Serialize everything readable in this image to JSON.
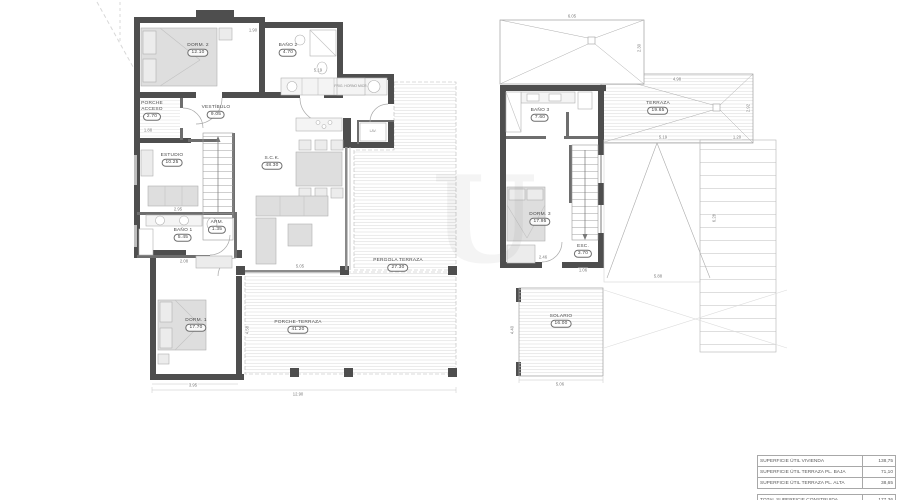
{
  "ground_floor": {
    "rooms": {
      "porche_acceso": {
        "name": "PORCHE ACCESO",
        "area": "2.70"
      },
      "dorm2": {
        "name": "DORM. 2",
        "area": "12.10"
      },
      "bano2": {
        "name": "BAÑO 2",
        "area": "4.70"
      },
      "vestibulo": {
        "name": "VESTÍBULO",
        "area": "9.05"
      },
      "estudio": {
        "name": "ESTUDIO",
        "area": "10.25"
      },
      "sck": {
        "name": "S.C.K.",
        "area": "48.30"
      },
      "bano1": {
        "name": "BAÑO 1",
        "area": "5.45"
      },
      "arm": {
        "name": "ARM.",
        "area": "1.35"
      },
      "dorm1": {
        "name": "DORM. 1",
        "area": "17.70"
      },
      "porche_terraza": {
        "name": "PORCHE-TERRAZA",
        "area": "41.20"
      },
      "pergola_terraza": {
        "name": "PERGOLA TERRAZA",
        "area": "27.30"
      }
    },
    "fixtures": {
      "kitchen_appliances": "FRIG. HORNO MICR.",
      "laundry": "LAV."
    },
    "dims": [
      "1.90",
      "5.19",
      "2.95",
      "2.08",
      "3.95",
      "12.90",
      "5.05",
      "1.88",
      "4.58"
    ]
  },
  "upper_floor": {
    "rooms": {
      "bano3": {
        "name": "BAÑO 3",
        "area": "7.60"
      },
      "terraza": {
        "name": "TERRAZA",
        "area": "19.65"
      },
      "dorm3": {
        "name": "DORM. 3",
        "area": "17.95"
      },
      "esc": {
        "name": "ESC.",
        "area": "3.70"
      },
      "solario": {
        "name": "SOLARIO",
        "area": "16.00"
      }
    },
    "dims": [
      "6.05",
      "2.30",
      "4.98",
      "2.92",
      "5.19",
      "1.20",
      "2.46",
      "1.06",
      "5.88",
      "6.28",
      "4.40",
      "5.06"
    ]
  },
  "summary_table": {
    "rows": [
      {
        "label": "SUPERFICIE ÚTIL VIVIENDA",
        "value": "138,75"
      },
      {
        "label": "SUPERFICIE ÚTIL TERRAZA PL. BAJA",
        "value": "71,10"
      },
      {
        "label": "SUPERFICIE ÚTIL TERRAZA PL. ALTA",
        "value": "38,65"
      }
    ],
    "total": {
      "label": "TOTAL SUPERFICIE CONSTRUIDA",
      "value": "177,36"
    }
  },
  "colors": {
    "wall": "#4e4e4e",
    "thin_line": "#9a9a9a",
    "hatch_line": "#d0d0d0",
    "furniture": "#dedede"
  }
}
